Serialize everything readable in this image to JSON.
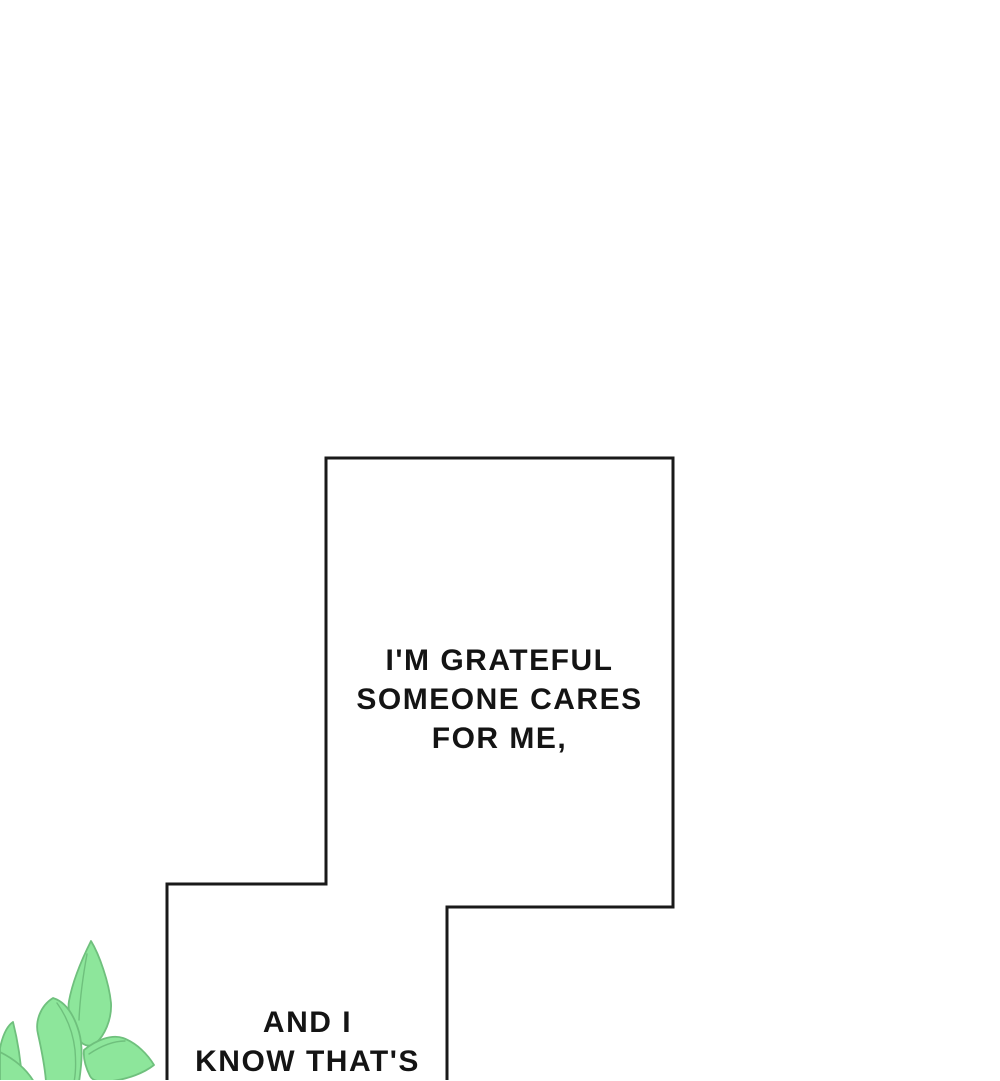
{
  "panel": {
    "background_color": "#ffffff",
    "border_color": "#1a1a1a",
    "text_color": "#141414"
  },
  "speech_bubbles": [
    {
      "name": "bubble-grateful",
      "lines": [
        "I'M GRATEFUL",
        "SOMEONE CARES",
        "FOR ME,"
      ]
    },
    {
      "name": "bubble-know",
      "lines": [
        "AND I",
        "KNOW THAT'S"
      ]
    }
  ],
  "illustration": {
    "name": "green-leaves",
    "leaf_fill": "#8de69b",
    "leaf_outline": "#6fc07d"
  }
}
